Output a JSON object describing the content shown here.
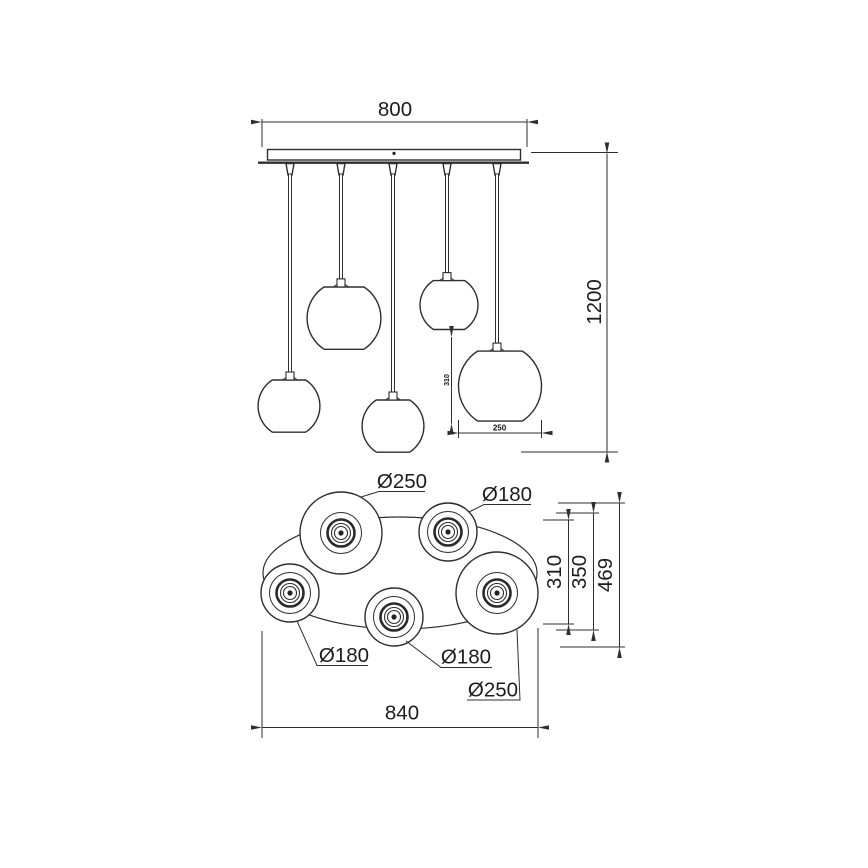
{
  "canvas": {
    "background": "#ffffff",
    "line_color": "#2e2e2e",
    "text_color": "#1d1d1d"
  },
  "elevation_view": {
    "canopy_width": "800",
    "total_drop": "1200",
    "right_shade_height": "310",
    "right_shade_diameter": "250"
  },
  "plan_view": {
    "shade_top_left": "Ø250",
    "shade_top_right": "Ø180",
    "shade_left": "Ø180",
    "shade_bottom_center": "Ø180",
    "shade_right": "Ø250",
    "depth_dim_inner": "310",
    "depth_dim_middle": "350",
    "depth_dim_overall": "469",
    "overall_width": "840"
  }
}
